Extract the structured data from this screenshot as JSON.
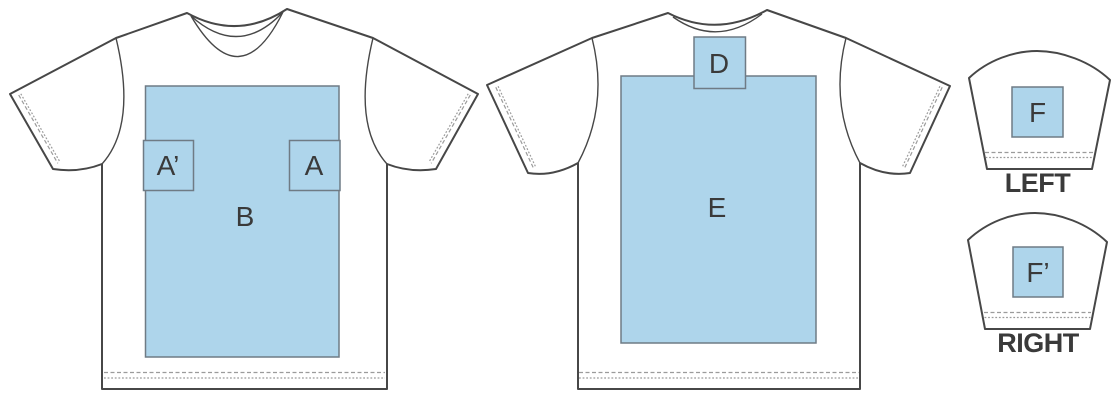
{
  "colors": {
    "zone_fill": "#AED5EB",
    "zone_border": "#6F7B85",
    "outline": "#474747",
    "stitch": "#9B9B9B",
    "label_text": "#3A3A3A",
    "background": "#FFFFFF"
  },
  "views": {
    "front": {
      "zones": {
        "a_prime": "A’",
        "a": "A",
        "b": "B"
      }
    },
    "back": {
      "zones": {
        "d": "D",
        "e": "E"
      }
    },
    "left_sleeve": {
      "caption": "LEFT",
      "zones": {
        "f": "F"
      }
    },
    "right_sleeve": {
      "caption": "RIGHT",
      "zones": {
        "f_prime": "F’"
      }
    }
  }
}
